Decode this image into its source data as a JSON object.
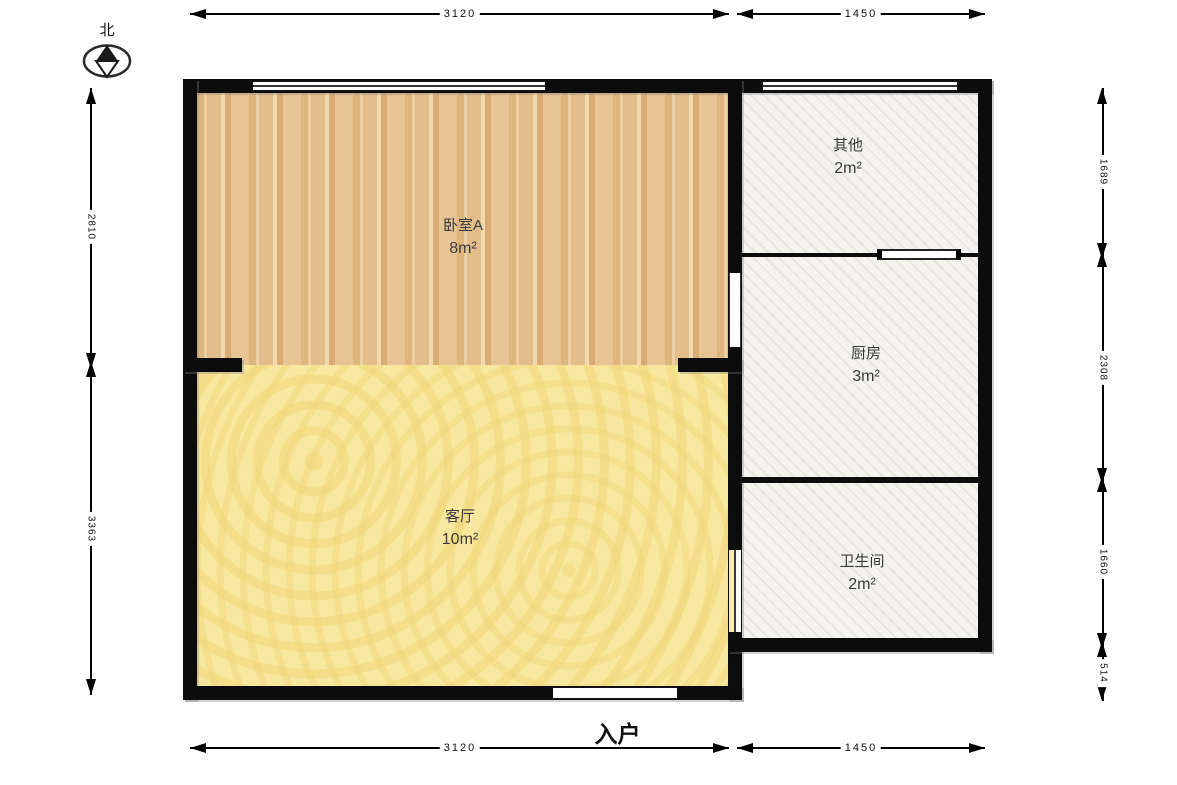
{
  "compass": {
    "north_label": "北"
  },
  "rooms": [
    {
      "name": "卧室A",
      "area": "8m²"
    },
    {
      "name": "客厅",
      "area": "10m²"
    },
    {
      "name": "其他",
      "area": "2m²"
    },
    {
      "name": "厨房",
      "area": "3m²"
    },
    {
      "name": "卫生间",
      "area": "2m²"
    }
  ],
  "entrance": {
    "label": "入户"
  },
  "dimensions": {
    "top": [
      "3120",
      "1450"
    ],
    "bottom": [
      "3120",
      "1450"
    ],
    "left": [
      "2810",
      "3363"
    ],
    "right": [
      "1689",
      "2308",
      "1660",
      "514"
    ]
  },
  "colors": {
    "wall": "#0c0c0c",
    "bedroom_floor": "#e6c28e",
    "living_floor": "#f8e79e",
    "service_floor": "#f4f3ef"
  }
}
